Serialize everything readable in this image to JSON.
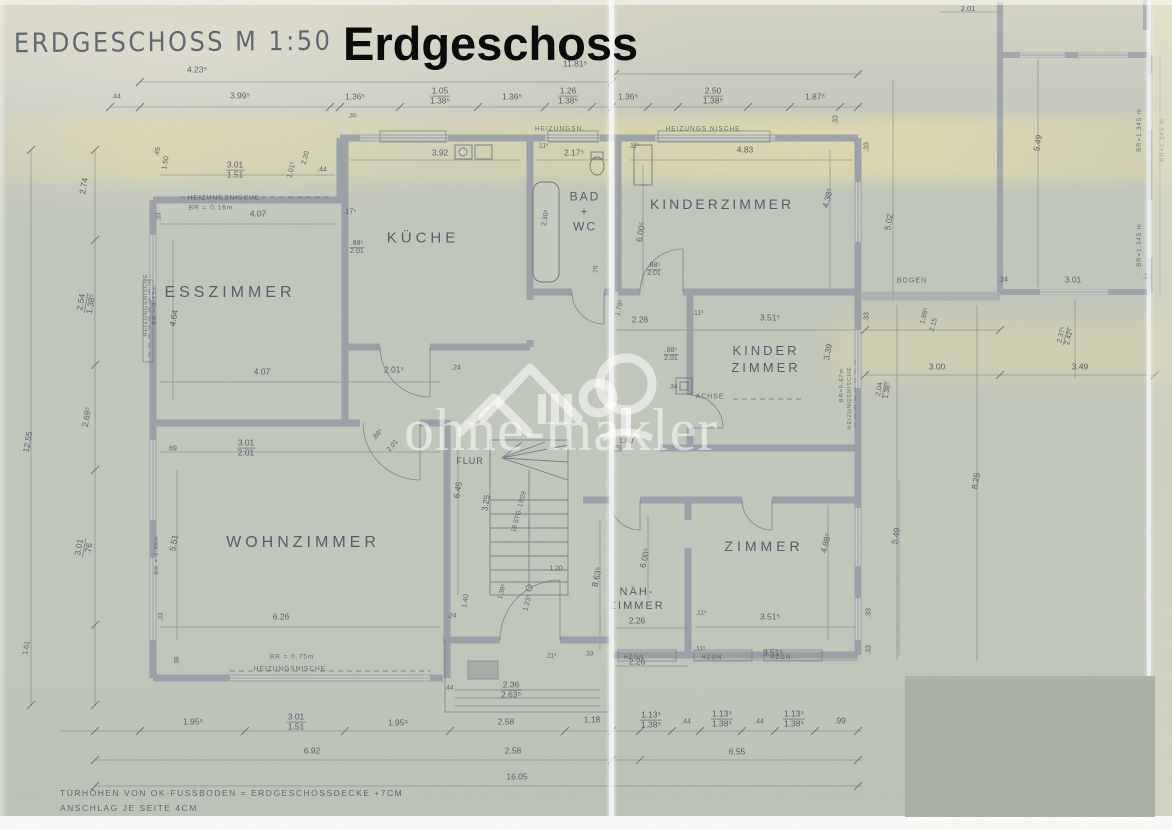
{
  "title": {
    "handwritten": "ERDGESCHOSS   M 1:50",
    "overlay": "Erdgeschoss"
  },
  "watermark": {
    "text": "ohne-makler"
  },
  "footer": {
    "line1": "TÜRHÖHEN VON OK-FUSSBODEN = ERDGESCHOSSDECKE +7CM",
    "line2": "ANSCHLAG JE SEITE 4CM"
  },
  "colors": {
    "paper": "#c3c8bc",
    "wall": "#8e96a2",
    "ink": "#4a5160",
    "watermark": "#ffffff",
    "redaction": "#a9b2a3",
    "overlay_title": "#0b0b0b",
    "tint_band": "#e8dca4"
  },
  "rooms": [
    {
      "id": "esszimmer",
      "lines": [
        "ESSZIMMER"
      ],
      "x": 230,
      "y": 293,
      "s": 16,
      "ls": 4
    },
    {
      "id": "kueche",
      "lines": [
        "KÜCHE"
      ],
      "x": 423,
      "y": 238,
      "s": 15,
      "ls": 4
    },
    {
      "id": "bad-wc",
      "lines": [
        "BAD",
        "+",
        "WC"
      ],
      "x": 585,
      "y": 212,
      "s": 12,
      "ls": 2,
      "lh": 15
    },
    {
      "id": "kinderzimmer",
      "lines": [
        "KINDERZIMMER"
      ],
      "x": 722,
      "y": 204,
      "s": 14,
      "ls": 3
    },
    {
      "id": "kinder-zimmer",
      "lines": [
        "KINDER",
        "ZIMMER"
      ],
      "x": 766,
      "y": 359,
      "s": 13,
      "ls": 3,
      "lh": 17
    },
    {
      "id": "wohnzimmer",
      "lines": [
        "WOHNZIMMER"
      ],
      "x": 303,
      "y": 543,
      "s": 16,
      "ls": 4
    },
    {
      "id": "naehzimmer",
      "lines": [
        "NÄH-",
        "ZIMMER"
      ],
      "x": 637,
      "y": 599,
      "s": 11,
      "ls": 2,
      "lh": 14
    },
    {
      "id": "zimmer",
      "lines": [
        "ZIMMER"
      ],
      "x": 764,
      "y": 546,
      "s": 14,
      "ls": 4
    },
    {
      "id": "flur",
      "lines": [
        "FLUR"
      ],
      "x": 470,
      "y": 461,
      "s": 9,
      "ls": 1
    }
  ],
  "annotations": [
    {
      "t": "4.23⁵",
      "x": 197,
      "y": 70
    },
    {
      "t": "11.81⁵",
      "x": 575,
      "y": 64
    },
    {
      "t": ".44",
      "x": 116,
      "y": 97,
      "s": 7
    },
    {
      "t": "3.99⁵",
      "x": 240,
      "y": 96
    },
    {
      "t": "1.36⁵",
      "x": 355,
      "y": 97
    },
    {
      "t": "1.05",
      "b": "1.38⁵",
      "x": 440,
      "y": 96
    },
    {
      "t": "1.36⁵",
      "x": 512,
      "y": 97
    },
    {
      "t": "1.26",
      "b": "1.38⁵",
      "x": 568,
      "y": 96
    },
    {
      "t": "1.36⁵",
      "x": 628,
      "y": 97
    },
    {
      "t": "2.50",
      "b": "1.38⁵",
      "x": 713,
      "y": 96
    },
    {
      "t": "1.87⁵",
      "x": 815,
      "y": 97
    },
    {
      "t": ".33",
      "x": 836,
      "y": 120,
      "r": -90,
      "s": 7
    },
    {
      "t": ".30",
      "x": 352,
      "y": 117,
      "s": 6.5
    },
    {
      "t": "HEIZUNGSN.",
      "x": 560,
      "y": 130,
      "s": 6.5,
      "k": "label"
    },
    {
      "t": "HEIZUNGS NISCHE",
      "x": 703,
      "y": 130,
      "s": 6.5,
      "k": "label"
    },
    {
      "t": "3.92",
      "x": 440,
      "y": 153
    },
    {
      "t": "2.17⁵",
      "x": 574,
      "y": 153
    },
    {
      "t": "4.83",
      "x": 745,
      "y": 150
    },
    {
      "t": ".11⁵",
      "x": 543,
      "y": 147,
      "s": 6.5
    },
    {
      "t": ".11⁵",
      "x": 634,
      "y": 147,
      "s": 6.5
    },
    {
      "t": "3.01",
      "b": "1.51",
      "x": 235,
      "y": 170
    },
    {
      "t": ".44",
      "x": 322,
      "y": 170,
      "s": 7
    },
    {
      "t": "2.20",
      "x": 306,
      "y": 158,
      "r": -75,
      "s": 7
    },
    {
      "t": "1.01⁵",
      "x": 292,
      "y": 170,
      "r": -75,
      "s": 7
    },
    {
      "t": ".45",
      "x": 158,
      "y": 152,
      "r": -80,
      "s": 7
    },
    {
      "t": "1.50",
      "x": 166,
      "y": 163,
      "r": -80,
      "s": 7
    },
    {
      "t": "HEIZUNGSNISCHE",
      "x": 224,
      "y": 199,
      "s": 6.5,
      "k": "label"
    },
    {
      "t": "BR = 0.16m",
      "x": 211,
      "y": 209,
      "s": 6.5,
      "k": "label"
    },
    {
      "t": "4.07",
      "x": 258,
      "y": 214
    },
    {
      "t": ".17⁵",
      "x": 350,
      "y": 212,
      "s": 7
    },
    {
      "t": ".33",
      "x": 160,
      "y": 217,
      "r": -90,
      "s": 6.5
    },
    {
      "t": "2.74",
      "x": 84,
      "y": 186,
      "r": -80
    },
    {
      "t": "2.54",
      "b": "1.38⁵",
      "x": 86,
      "y": 303,
      "r": -80
    },
    {
      "t": "2.69⁵",
      "x": 87,
      "y": 417,
      "r": -80
    },
    {
      "t": "12.55",
      "x": 28,
      "y": 442,
      "r": -80
    },
    {
      "t": "3.01",
      "b": ".76",
      "x": 84,
      "y": 548,
      "r": -80
    },
    {
      "t": "1.61",
      "x": 27,
      "y": 648,
      "r": -80,
      "s": 7
    },
    {
      "t": "HEIZUNGSNISCHE",
      "x": 147,
      "y": 305,
      "r": -90,
      "s": 5.5,
      "k": "label"
    },
    {
      "t": "BR = 0.83m",
      "x": 156,
      "y": 305,
      "r": -90,
      "s": 5.5,
      "k": "label"
    },
    {
      "t": "4.64",
      "x": 174,
      "y": 318,
      "r": -80
    },
    {
      "t": ".88⁵",
      "b": "2.01",
      "x": 357,
      "y": 248,
      "s": 7
    },
    {
      "t": "4.07",
      "x": 262,
      "y": 372
    },
    {
      "t": "2.01⁵",
      "x": 394,
      "y": 370
    },
    {
      "t": ".24",
      "x": 456,
      "y": 368,
      "s": 7
    },
    {
      "t": "3.01",
      "b": "2.01",
      "x": 246,
      "y": 448
    },
    {
      "t": ".69",
      "x": 172,
      "y": 449,
      "s": 7
    },
    {
      "t": ".88⁵",
      "x": 378,
      "y": 435,
      "r": -50,
      "s": 7
    },
    {
      "t": "2.01",
      "x": 393,
      "y": 446,
      "r": -50,
      "s": 7
    },
    {
      "t": "5.51",
      "x": 174,
      "y": 543,
      "r": -80
    },
    {
      "t": "BR = 1.88m",
      "x": 158,
      "y": 555,
      "r": -90,
      "s": 5.5,
      "k": "label"
    },
    {
      "t": ".33",
      "x": 162,
      "y": 617,
      "r": -90,
      "s": 6.5
    },
    {
      "t": ".38",
      "x": 178,
      "y": 661,
      "r": -90,
      "s": 6.5
    },
    {
      "t": "6.26",
      "x": 281,
      "y": 617
    },
    {
      "t": "BR = 0.75m",
      "x": 292,
      "y": 658,
      "s": 6.5,
      "k": "label"
    },
    {
      "t": "HEIZUNGSNISCHE",
      "x": 290,
      "y": 670,
      "s": 6.5,
      "k": "label"
    },
    {
      "t": "6.45",
      "x": 458,
      "y": 490,
      "r": -80
    },
    {
      "t": "3.25",
      "x": 486,
      "y": 503,
      "r": -80
    },
    {
      "t": "18 STG. 17/28",
      "x": 520,
      "y": 512,
      "r": -75,
      "s": 6.5
    },
    {
      "t": "1.20",
      "x": 556,
      "y": 569,
      "s": 7
    },
    {
      "t": "1.40",
      "x": 466,
      "y": 601,
      "r": -80,
      "s": 7
    },
    {
      "t": ".24",
      "x": 452,
      "y": 617,
      "s": 6.5
    },
    {
      "t": "1.23⁵",
      "x": 528,
      "y": 603,
      "r": -75,
      "s": 7
    },
    {
      "t": "1.38⁵",
      "x": 503,
      "y": 592,
      "r": -75,
      "s": 6.5
    },
    {
      "t": ".11⁵",
      "x": 551,
      "y": 657,
      "s": 6.5
    },
    {
      "t": ".33",
      "x": 589,
      "y": 655,
      "s": 6.5
    },
    {
      "t": ".44",
      "x": 449,
      "y": 689,
      "s": 6.5
    },
    {
      "t": "2.36",
      "b": "2.63⁵",
      "x": 511,
      "y": 690
    },
    {
      "t": "1.95⁵",
      "x": 193,
      "y": 722
    },
    {
      "t": "3.01",
      "b": "1.51",
      "x": 296,
      "y": 722
    },
    {
      "t": "1.95⁵",
      "x": 398,
      "y": 723
    },
    {
      "t": "2.58",
      "x": 506,
      "y": 722
    },
    {
      "t": "1.18",
      "x": 592,
      "y": 720
    },
    {
      "t": "6.92",
      "x": 312,
      "y": 751
    },
    {
      "t": "2.58",
      "x": 513,
      "y": 751
    },
    {
      "t": "16.05",
      "x": 517,
      "y": 777
    },
    {
      "t": "2.30⁵",
      "x": 546,
      "y": 218,
      "r": -80,
      "s": 7
    },
    {
      "t": ".76",
      "x": 597,
      "y": 270,
      "r": -90,
      "s": 6.5
    },
    {
      "t": "6.00⁵",
      "x": 641,
      "y": 232,
      "r": -80
    },
    {
      "t": "4.38⁵",
      "x": 828,
      "y": 198,
      "r": -75
    },
    {
      "t": "5.02",
      "x": 889,
      "y": 222,
      "r": -80
    },
    {
      "t": ".88⁵",
      "b": "2.01",
      "x": 654,
      "y": 270,
      "s": 7
    },
    {
      "t": ".33",
      "x": 867,
      "y": 147,
      "r": -90,
      "s": 7
    },
    {
      "t": ".33",
      "x": 867,
      "y": 317,
      "r": -90,
      "s": 7
    },
    {
      "t": "2.26",
      "x": 640,
      "y": 320
    },
    {
      "t": "3.51⁵",
      "x": 770,
      "y": 318
    },
    {
      "t": "1.79⁵",
      "x": 620,
      "y": 308,
      "r": -75,
      "s": 7
    },
    {
      "t": ".11⁵",
      "x": 698,
      "y": 314,
      "s": 6.5
    },
    {
      "t": ".88⁵",
      "b": "2.01",
      "x": 671,
      "y": 355,
      "s": 7
    },
    {
      "t": "3.39",
      "x": 828,
      "y": 352,
      "r": -80
    },
    {
      "t": "ACHSE",
      "x": 710,
      "y": 397,
      "s": 7,
      "k": "label"
    },
    {
      "t": ".34",
      "x": 673,
      "y": 388,
      "s": 6.5
    },
    {
      "t": "BR=0.67m",
      "x": 843,
      "y": 385,
      "r": -90,
      "s": 5.5,
      "k": "label"
    },
    {
      "t": "HEIZUNGSNISCHE",
      "x": 851,
      "y": 398,
      "r": -90,
      "s": 5.5,
      "k": "label"
    },
    {
      "t": "1.60",
      "x": 626,
      "y": 441,
      "s": 7.5
    },
    {
      "t": "8.63⁵",
      "x": 597,
      "y": 577,
      "r": -78
    },
    {
      "t": "6.00⁵",
      "x": 645,
      "y": 558,
      "r": -78
    },
    {
      "t": "2.26",
      "x": 637,
      "y": 621
    },
    {
      "t": "2.26",
      "x": 637,
      "y": 662
    },
    {
      "t": "3.51⁵",
      "x": 770,
      "y": 617
    },
    {
      "t": ".11⁵",
      "x": 701,
      "y": 614,
      "s": 6.5
    },
    {
      "t": "3.51⁵",
      "x": 773,
      "y": 653
    },
    {
      "t": ".11⁵",
      "x": 700,
      "y": 650,
      "s": 6.5
    },
    {
      "t": "4.88⁵",
      "x": 826,
      "y": 543,
      "r": -75
    },
    {
      "t": "5.49",
      "x": 896,
      "y": 536,
      "r": -80
    },
    {
      "t": ".33",
      "x": 869,
      "y": 613,
      "r": -90,
      "s": 7
    },
    {
      "t": ".33",
      "x": 869,
      "y": 650,
      "r": -90,
      "s": 7
    },
    {
      "t": "HZGN",
      "x": 634,
      "y": 658,
      "s": 6,
      "k": "label"
    },
    {
      "t": "HZGN",
      "x": 712,
      "y": 658,
      "s": 6,
      "k": "label"
    },
    {
      "t": "HZGN.",
      "x": 782,
      "y": 658,
      "s": 6,
      "k": "label"
    },
    {
      "t": "1.13⁵",
      "b": "1.38⁵",
      "x": 651,
      "y": 720
    },
    {
      "t": ".44",
      "x": 686,
      "y": 722,
      "s": 7
    },
    {
      "t": "1.13⁵",
      "b": "1.38⁵",
      "x": 722,
      "y": 719
    },
    {
      "t": ".44",
      "x": 759,
      "y": 722,
      "s": 7
    },
    {
      "t": "1.13⁵",
      "b": "1.38⁵",
      "x": 794,
      "y": 719
    },
    {
      "t": ".99",
      "x": 840,
      "y": 721
    },
    {
      "t": "6.55",
      "x": 737,
      "y": 752
    },
    {
      "t": "BOGEN",
      "x": 912,
      "y": 281,
      "s": 7,
      "k": "label"
    },
    {
      "t": "1.88⁵",
      "x": 925,
      "y": 316,
      "r": -75,
      "s": 7
    },
    {
      "t": "2.15",
      "x": 934,
      "y": 325,
      "r": -75,
      "s": 7
    },
    {
      "t": ".24",
      "x": 1003,
      "y": 280,
      "s": 7
    },
    {
      "t": "3.01",
      "x": 1073,
      "y": 280
    },
    {
      "t": ".24",
      "x": 1147,
      "y": 277,
      "s": 7
    },
    {
      "t": "3.00",
      "x": 937,
      "y": 367
    },
    {
      "t": "3.49",
      "x": 1080,
      "y": 367
    },
    {
      "t": "2.37⁵",
      "b": "2.42⁵",
      "x": 1066,
      "y": 336,
      "r": -75,
      "s": 7
    },
    {
      "t": "2.04",
      "b": "1.38⁵",
      "x": 884,
      "y": 390,
      "r": -80,
      "s": 7
    },
    {
      "t": "8.25",
      "x": 976,
      "y": 481,
      "r": -80
    },
    {
      "t": "5.49",
      "x": 1038,
      "y": 143,
      "r": -80
    },
    {
      "t": "2.01",
      "x": 968,
      "y": 9,
      "s": 7.5
    },
    {
      "t": "BR=1.345 m",
      "x": 1140,
      "y": 130,
      "r": -90,
      "s": 6,
      "k": "label"
    },
    {
      "t": "BR=1.345 m",
      "x": 1140,
      "y": 245,
      "r": -90,
      "s": 6,
      "k": "label"
    },
    {
      "t": "BR=1.345 m",
      "x": 1163,
      "y": 140,
      "r": -90,
      "s": 6,
      "k": "label"
    }
  ]
}
